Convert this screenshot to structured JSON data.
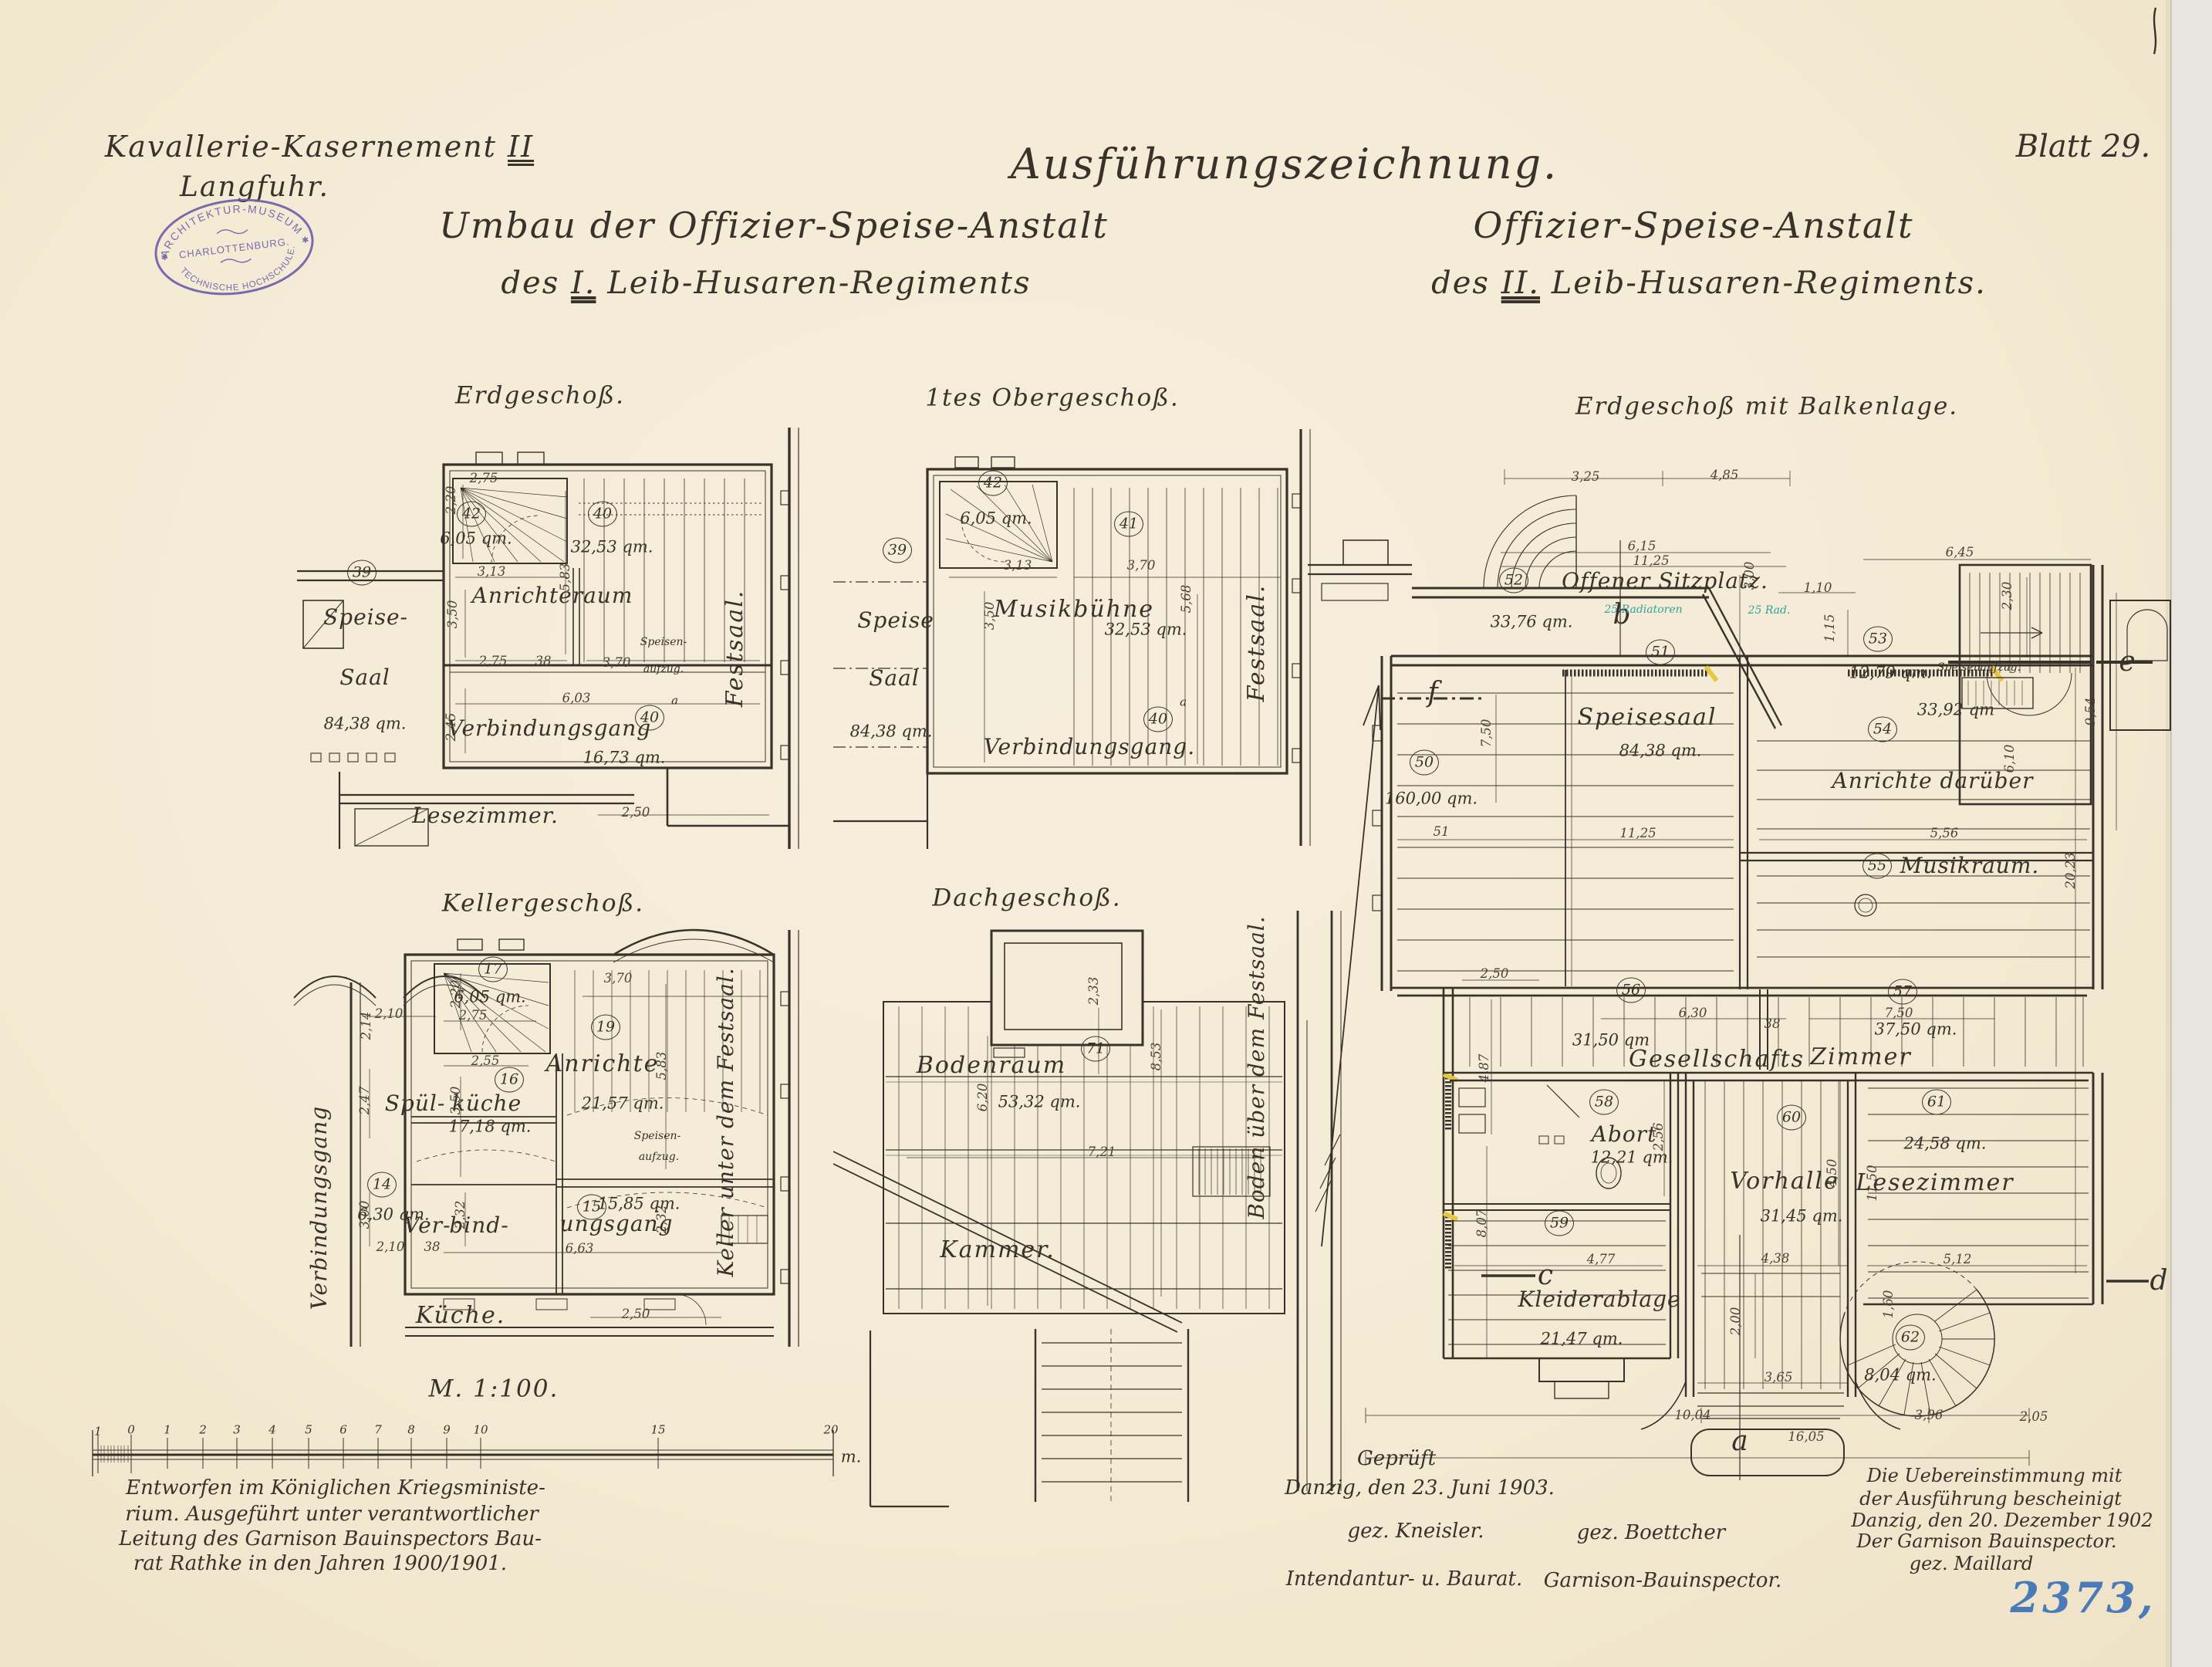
{
  "colors": {
    "paper": "#f5ecd8",
    "ink": "#38322b",
    "stamp_purple": "#6a58a8",
    "teal_annotation": "#2fa39c",
    "blue_number": "#4a7ab8"
  },
  "header": {
    "site_line1_main": "Kavallerie-Kasernement",
    "site_line1_num": "II",
    "site_line2": "Langfuhr.",
    "drawing_type": "Ausführungszeichnung.",
    "sheet": "Blatt 29.",
    "title_left_1": "Umbau der Offizier-Speise-Anstalt",
    "title_left_2a": "des",
    "title_left_2num": "I.",
    "title_left_2b": "Leib-Husaren-Regiments",
    "title_right_1": "Offizier-Speise-Anstalt",
    "title_right_2a": "des",
    "title_right_2num": "II.",
    "title_right_2b": "Leib-Husaren-Regiments."
  },
  "stamp": {
    "top": "ARCHITEKTUR-MUSEUM",
    "middle": "CHARLOTTENBURG.",
    "bottom": "TECHNISCHE HOCHSCHULE."
  },
  "plans": {
    "eg": {
      "title": "Erdgeschoß.",
      "speisesaal_num": "39",
      "speisesaal_1": "Speise-",
      "speisesaal_2": "Saal",
      "speisesaal_area": "84,38 qm.",
      "stair_num": "42",
      "stair_area": "6,05 qm.",
      "anricht_num": "40",
      "anricht_name": "Anrichteraum",
      "anricht_area": "32,53 qm.",
      "gang_num": "40",
      "gang_suffix": "a",
      "gang_name": "Verbindungsgang",
      "gang_area": "16,73 qm.",
      "aufzug_1": "Speisen-",
      "aufzug_2": "aufzug.",
      "lesezimmer": "Lesezimmer.",
      "festsaal": "Festsaal.",
      "dims": [
        "2,75",
        "2,20",
        "3,13",
        "5,83",
        "3,50",
        "2,75",
        "3,70",
        "6,03",
        "2,45",
        "2,50",
        "38"
      ]
    },
    "og": {
      "title": "1tes Obergeschoß.",
      "speisesaal_num": "39",
      "speisesaal_1": "Speise",
      "speisesaal_2": "Saal",
      "speisesaal_area": "84,38 qm.",
      "stair_num": "42",
      "stair_area": "6,05 qm.",
      "buehne_num": "41",
      "buehne_name": "Musikbühne",
      "buehne_area": "32,53 qm.",
      "gang_num": "40",
      "gang_suffix": "a",
      "gang_name": "Verbindungsgang.",
      "festsaal": "Festsaal.",
      "dims": [
        "3,13",
        "3,70",
        "3,50",
        "5,68"
      ]
    },
    "kg": {
      "title": "Kellergeschoß.",
      "gang_vert": "Verbindungsgang",
      "stair_num": "17",
      "stair_area": "6,05 qm.",
      "anrichte_num": "19",
      "anrichte_name": "Anrichte",
      "anrichte_area": "21,57 qm.",
      "kueche_num": "16",
      "kueche_1": "Spül-",
      "kueche_2": "küche",
      "kueche_area": "17,18 qm.",
      "r14_num": "14",
      "r14_area": "6,30 qm.",
      "r15_num": "15",
      "r15_1": "Ver-",
      "r15_2": "bind-",
      "r15_3": "ungsgang",
      "r15_area": "15,85 qm.",
      "aufzug_1": "Speisen-",
      "aufzug_2": "aufzug.",
      "kueche_label": "Küche.",
      "keller_vert": "Keller unter dem Festsaal.",
      "dims": [
        "2,20",
        "2,75",
        "2,10",
        "2,14",
        "3,70",
        "2,55",
        "3,50",
        "5,83",
        "2,47",
        "3,00",
        "2,32",
        "6,63",
        "2,10",
        "38",
        "2,50"
      ]
    },
    "dg": {
      "title": "Dachgeschoß.",
      "boden_num": "71",
      "boden_name": "Bodenraum",
      "boden_area": "53,32 qm.",
      "kammer": "Kammer.",
      "boden_vert": "Boden über dem Festsaal.",
      "dims": [
        "2,33",
        "8,53",
        "6,20",
        "7,21"
      ]
    },
    "bl": {
      "title": "Erdgeschoß mit Balkenlage.",
      "r50_num": "50",
      "r50_area": "160,00 qm.",
      "r51_num": "51",
      "r51_name": "Speisesaal",
      "r51_area": "84,38 qm.",
      "r52_num": "52",
      "r52_name": "Offener Sitzplatz.",
      "r52_area": "33,76 qm.",
      "r53_num": "53",
      "r53_area": "12,79 qm.",
      "r54_num": "54",
      "r54_name": "Anrichte darüber",
      "r54_area": "33,92 qm",
      "r55_num": "55",
      "r55_name": "Musikraum.",
      "r56_num": "56",
      "r56_area": "31,50 qm",
      "r57_num": "57",
      "r57_area": "37,50 qm.",
      "r5657_name_1": "Gesellschafts",
      "r5657_name_2": "Zimmer",
      "r58_num": "58",
      "r58_name": "Abort",
      "r58_area": "12,21 qm.",
      "r59_num": "59",
      "r59_name": "Kleiderablage",
      "r59_area": "21,47 qm.",
      "r60_num": "60",
      "r60_name": "Vorhalle",
      "r60_area": "31,45 qm.",
      "r61_num": "61",
      "r61_name": "Lesezimmer",
      "r61_area": "24,58 qm.",
      "r62_num": "62",
      "r62_area": "8,04 qm.",
      "aufzug": "Speisenaufzug.",
      "radiator_1": "25 Radiatoren",
      "radiator_2": "25 Rad.",
      "letters": {
        "a": "a",
        "b": "b",
        "c": "c",
        "d": "d",
        "e": "e",
        "f": "f"
      },
      "dims": [
        "3,25",
        "4,85",
        "6,15",
        "11,25",
        "3,00",
        "1,10",
        "1,15",
        "6,45",
        "2,30",
        "9,54",
        "6,10",
        "5,56",
        "20,23",
        "7,50",
        "11,25",
        "2,50",
        "4,87",
        "6,30",
        "7,50",
        "38",
        "8,07",
        "2,56",
        "4,77",
        "4,38",
        "5,12",
        "4,50",
        "11,50",
        "3,65",
        "10,04",
        "3,96",
        "2,05",
        "16,05",
        "2,00",
        "51",
        "1,60"
      ]
    }
  },
  "scale_bar": {
    "label": "M. 1:100.",
    "ticks": [
      "1",
      "0",
      "1",
      "2",
      "3",
      "4",
      "5",
      "6",
      "7",
      "8",
      "9",
      "10",
      "15",
      "20"
    ],
    "unit": "m."
  },
  "note_designed": {
    "lines": [
      "Entworfen im Königlichen Kriegsministe-",
      "rium. Ausgeführt unter verantwortlicher",
      "Leitung des Garnison Bauinspectors Bau-",
      "rat Rathke in den Jahren 1900/1901."
    ]
  },
  "note_checked": {
    "title": "Geprüft",
    "line": "Danzig, den 23. Juni 1903.",
    "sig_left": "gez. Kneisler.",
    "sig_right": "gez. Boettcher",
    "role_left": "Intendantur- u. Baurat.",
    "role_right": "Garnison-Bauinspector."
  },
  "note_certified": {
    "lines": [
      "Die Uebereinstimmung mit",
      "der Ausführung bescheinigt",
      "Danzig, den 20. Dezember 1902",
      "Der Garnison Bauinspector."
    ],
    "signature": "gez. Maillard"
  },
  "archive_number": "2373,"
}
